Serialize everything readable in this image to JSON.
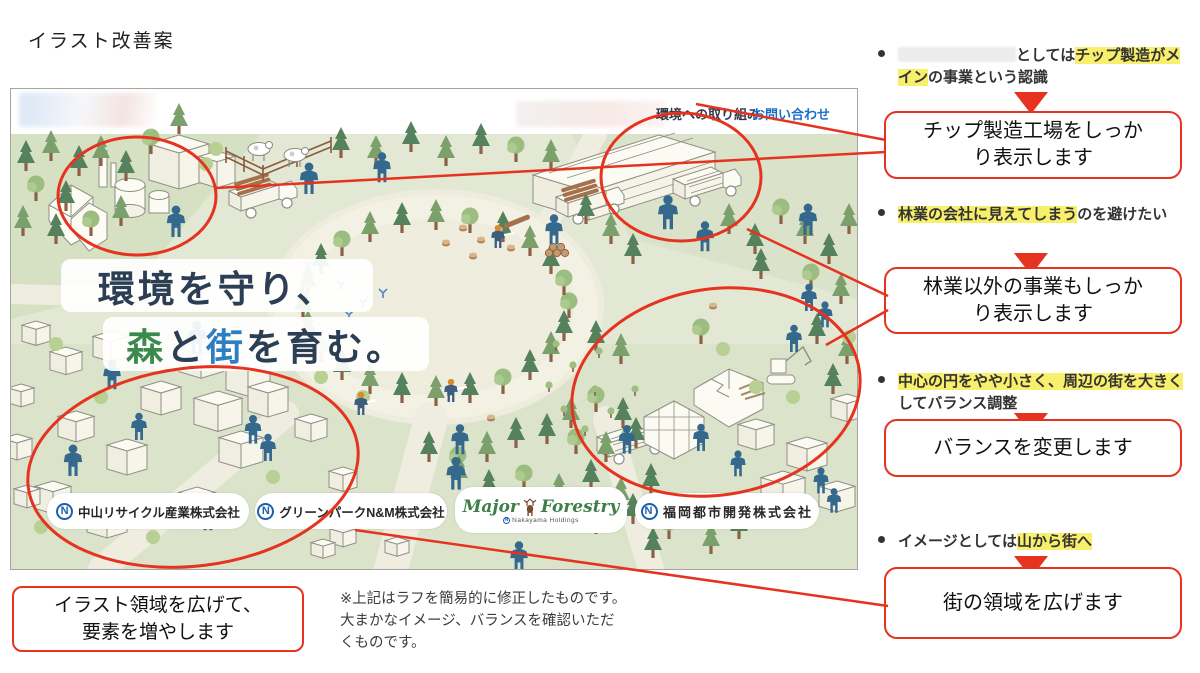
{
  "page": {
    "title": "イラスト改善案"
  },
  "colors": {
    "accent_red": "#e5331f",
    "highlight_yellow": "#f8ef6d",
    "headline_navy": "#2b3e54",
    "forest_green": "#3a8a4e",
    "town_blue": "#2d7ec2",
    "link_blue": "#1a6fc8"
  },
  "screenshot": {
    "nav": {
      "link_initiatives": "環境への取り組み",
      "link_contact": "お問い合わせ"
    },
    "headline": {
      "line1": "環境を守り、",
      "line2_segments": [
        {
          "text": "森",
          "color": "#3a8a4e"
        },
        {
          "text": "と",
          "color": "#2b3e54"
        },
        {
          "text": "街",
          "color": "#2d7ec2"
        },
        {
          "text": "を育む。",
          "color": "#2b3e54"
        }
      ]
    },
    "logos": [
      {
        "text": "中山リサイクル産業株式会社"
      },
      {
        "text": "グリーンパークN&M株式会社"
      },
      {
        "word1": "Major",
        "word2": "Forestry",
        "sub": "Nakayama Holdings"
      },
      {
        "text": "福岡都市開発株式会社"
      }
    ],
    "logo_mark": "N"
  },
  "annotations": [
    {
      "bullet_segments": [
        {
          "redacted": true
        },
        {
          "text": "としては"
        },
        {
          "text": "チップ製造がメイン",
          "highlight": true
        },
        {
          "text": "の事業という認識"
        }
      ],
      "box": "チップ製造工場をしっかり表示します"
    },
    {
      "bullet_segments": [
        {
          "text": "林業の会社に見えてしまう",
          "highlight": true
        },
        {
          "text": "のを避けたい"
        }
      ],
      "box": "林業以外の事業もしっかり表示します"
    },
    {
      "bullet_segments": [
        {
          "text": "中心の円をやや小さく、周辺の街を大きく",
          "highlight": true
        },
        {
          "text": "してバランス調整"
        }
      ],
      "box": "バランスを変更します"
    },
    {
      "bullet_segments": [
        {
          "text": "イメージとしては"
        },
        {
          "text": "山から街へ",
          "highlight": true
        }
      ],
      "box": "街の領域を広げます"
    }
  ],
  "footer": {
    "callout": "イラスト領域を広げて、要素を増やします",
    "note": "※上記はラフを簡易的に修正したものです。大まかなイメージ、バランスを確認いただくものです。"
  }
}
